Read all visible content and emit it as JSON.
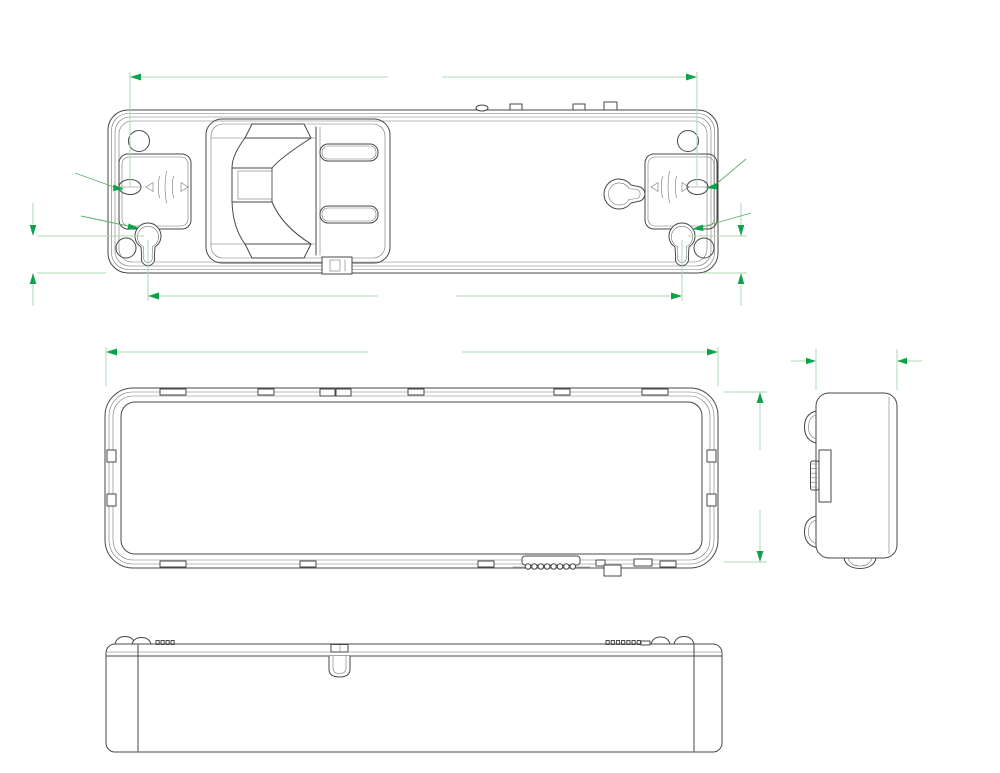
{
  "drawing": {
    "type": "technical-drawing",
    "product": "Rechargeable emergency LED light - dimensional drawing",
    "units": "mm",
    "colors": {
      "outline": "#474747",
      "dim_line": "#abd9ae",
      "dim_arrow": "#0ca24d",
      "dim_text": "#9d9d9d",
      "background": "#ffffff"
    },
    "views": {
      "back": {
        "label": "back view",
        "dims": {
          "mount_slot_span": "186.30",
          "keyhole_span": "175.52",
          "keyhole_offset_left": "12.94",
          "keyhole_offset_right": "12.94",
          "slot_dia_left": "ø3.50",
          "slot_dia_right": "ø3.50",
          "keyhole_dia_left": "ø6.00",
          "keyhole_dia_right": "ø6.00"
        },
        "vent_slots": 8
      },
      "front": {
        "label": "front view",
        "dims": {
          "width": "202.28",
          "height": "56.04"
        },
        "led_grid": {
          "rows": 3,
          "cols": 10,
          "total": 30
        }
      },
      "side": {
        "label": "side view",
        "dims": {
          "depth": "29.69"
        }
      },
      "bottom": {
        "label": "bottom view"
      }
    }
  }
}
